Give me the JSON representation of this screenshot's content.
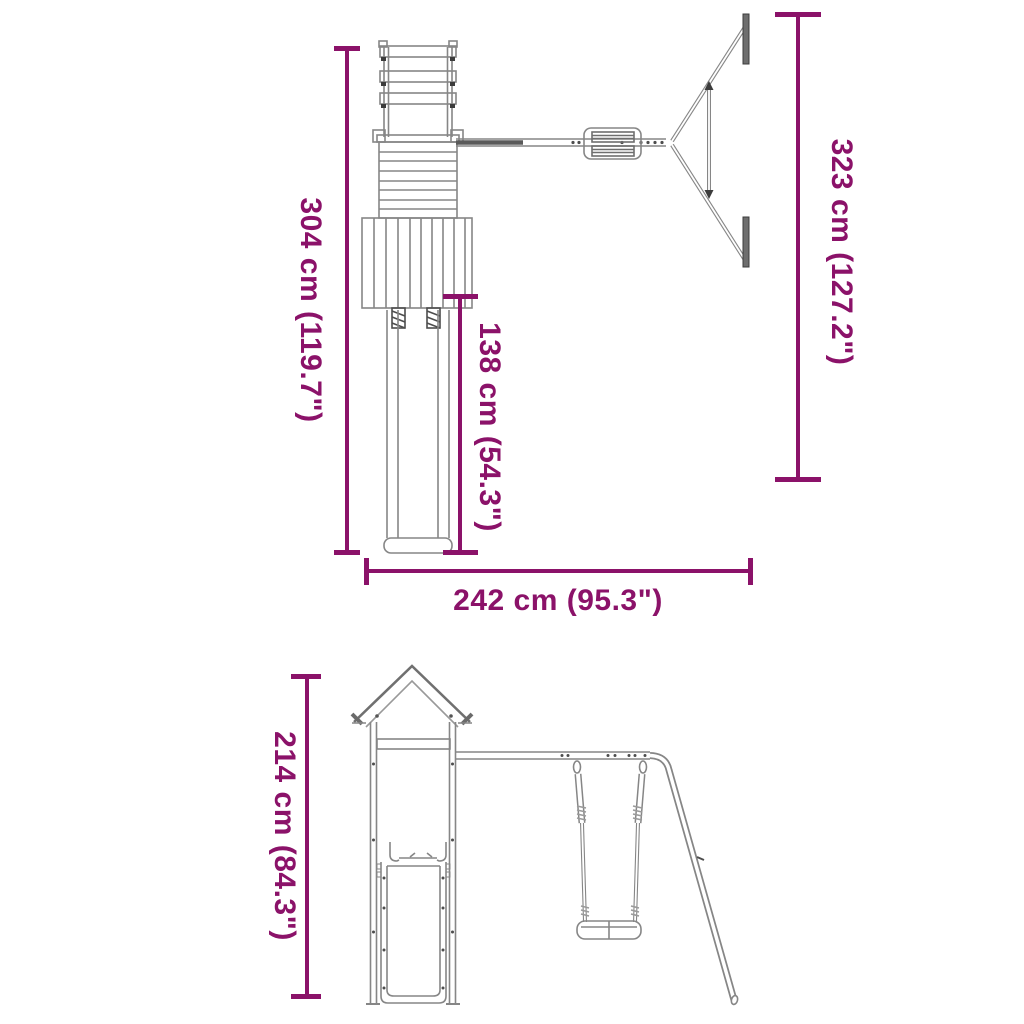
{
  "image_type": "product dimension diagram",
  "product": "wooden playset with tower, slide and single swing",
  "colors": {
    "background": "#ffffff",
    "dimension_accent": "#8B1269",
    "drawing_line": "#868686",
    "drawing_dark": "#4d4d4d"
  },
  "views": {
    "top_view": {
      "title": "top view (plan)",
      "dimensions": {
        "depth_total": {
          "cm": "304",
          "inches": "119.7",
          "label": "304 cm (119.7\")"
        },
        "slide_length": {
          "cm": "138",
          "inches": "54.3",
          "label": "138 cm (54.3\")"
        },
        "swing_frame_depth": {
          "cm": "323",
          "inches": "127.2",
          "label": "323 cm (127.2\")"
        },
        "width_total": {
          "cm": "242",
          "inches": "95.3",
          "label": "242 cm (95.3\")"
        }
      }
    },
    "front_view": {
      "title": "front view (elevation)",
      "dimensions": {
        "height_total": {
          "cm": "214",
          "inches": "84.3",
          "label": "214 cm (84.3\")"
        }
      }
    }
  }
}
